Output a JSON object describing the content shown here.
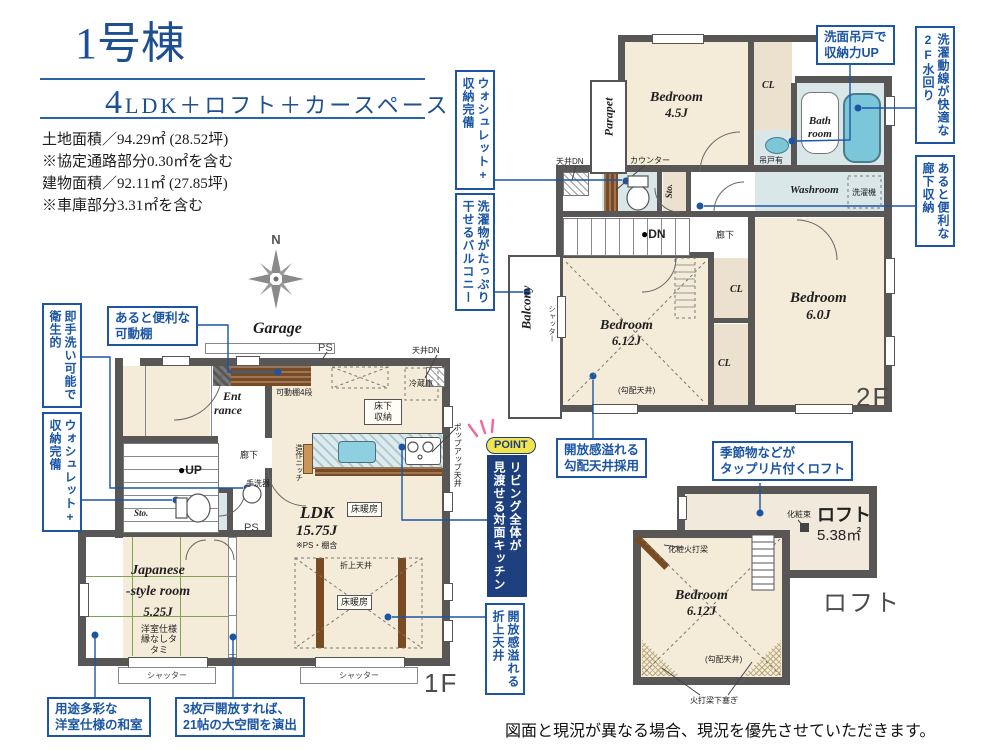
{
  "header": {
    "title": "1号棟",
    "subtitle_num": "4",
    "subtitle_rest": "LDK＋ロフト＋カースペース",
    "area_lines": [
      "土地面積／94.29㎡ (28.52坪)",
      "※協定通路部分0.30㎡を含む",
      "建物面積／92.11㎡ (27.85坪)",
      "※車庫部分3.31㎡を含む"
    ]
  },
  "compass": {
    "north": "N"
  },
  "f1": {
    "floor_tag": "1F",
    "garage": "Garage",
    "entrance_l1": "Ent",
    "entrance_l2": "rance",
    "corridor": "廊下",
    "up": "UP",
    "sto": "Sto.",
    "ps_top": "PS",
    "ps_mid": "PS",
    "tenjo_dn": "天井DN",
    "reizouko": "冷蔵庫",
    "yukashita_l1": "床下",
    "yukashita_l2": "収納",
    "kadoudana": "可動棚4段",
    "tearaiki": "手洗器",
    "zousaku": "造作ニッチ",
    "popup": "ポップアップ天井",
    "ldk_name": "LDK",
    "ldk_size": "15.75J",
    "ldk_note": "※PS・棚含",
    "yukadan1": "床暖房",
    "yukadan2": "床暖房",
    "oriage": "折上天井",
    "jroom_l1": "Japanese",
    "jroom_l2": "-style room",
    "jroom_size": "5.25J",
    "jroom_note1": "洋室仕様",
    "jroom_note2": "縁なしタタミ",
    "shutter1": "シャッター",
    "shutter2": "シャッター"
  },
  "f2": {
    "floor_tag": "2F",
    "parapet": "Parapet",
    "bedroom45_name": "Bedroom",
    "bedroom45_size": "4.5J",
    "cl_top": "CL",
    "cl_mid": "CL",
    "cl_low": "CL",
    "bath_l1": "Bath",
    "bath_l2": "room",
    "tsuridoari": "吊戸有",
    "washroom": "Washroom",
    "sentakuki": "洗濯機",
    "counter": "カウンター",
    "sto": "Sto.",
    "tenjo_dn": "天井DN",
    "dn": "DN",
    "corridor": "廊下",
    "balcony": "Balcony",
    "shutter": "シャッター",
    "bedroom612_name": "Bedroom",
    "bedroom612_size": "6.12J",
    "kobai": "(勾配天井)",
    "bedroom60_name": "Bedroom",
    "bedroom60_size": "6.0J"
  },
  "loft": {
    "tag": "ロフト",
    "loft_name": "ロフト",
    "loft_size": "5.38㎡",
    "keshouzuka": "化粧束",
    "keshouhiuchi": "化粧火打梁",
    "bedroom_name": "Bedroom",
    "bedroom_size": "6.12J",
    "kobai": "(勾配天井)",
    "hiuchi_shita": "火打梁下塞ぎ"
  },
  "callouts": {
    "kadou": [
      "あると便利な",
      "可動棚"
    ],
    "sokutearai": [
      "即手洗い可能で",
      "衛生的"
    ],
    "washlet1f": [
      "ウォシュレット+",
      "収納完備"
    ],
    "youto": [
      "用途多彩な",
      "洋室仕様の和室"
    ],
    "sanmai": [
      "3枚戸開放すれば、",
      "21帖の大空間を演出"
    ],
    "oriage": [
      "開放感溢れる",
      "折上天井"
    ],
    "washlet2f": [
      "ウォシュレット+",
      "収納完備"
    ],
    "balcony": [
      "洗濯物がたっぷり",
      "干せるバルコニー"
    ],
    "senmen": [
      "洗面吊戸で",
      "収納力UP"
    ],
    "suimawari": [
      "洗濯動線が快適な",
      "2F水回り"
    ],
    "roukashuno": [
      "あると便利な",
      "廊下収納"
    ],
    "kobai": [
      "開放感溢れる",
      "勾配天井採用"
    ],
    "kisetsu": [
      "季節物などが",
      "タップリ片付くロフト"
    ]
  },
  "point": {
    "badge": "POINT",
    "cols": [
      "リビング全体が",
      "見渡せる対面キッチン"
    ]
  },
  "footer": {
    "disclaimer": "図面と現況が異なる場合、現況を優先させていただきます。"
  }
}
